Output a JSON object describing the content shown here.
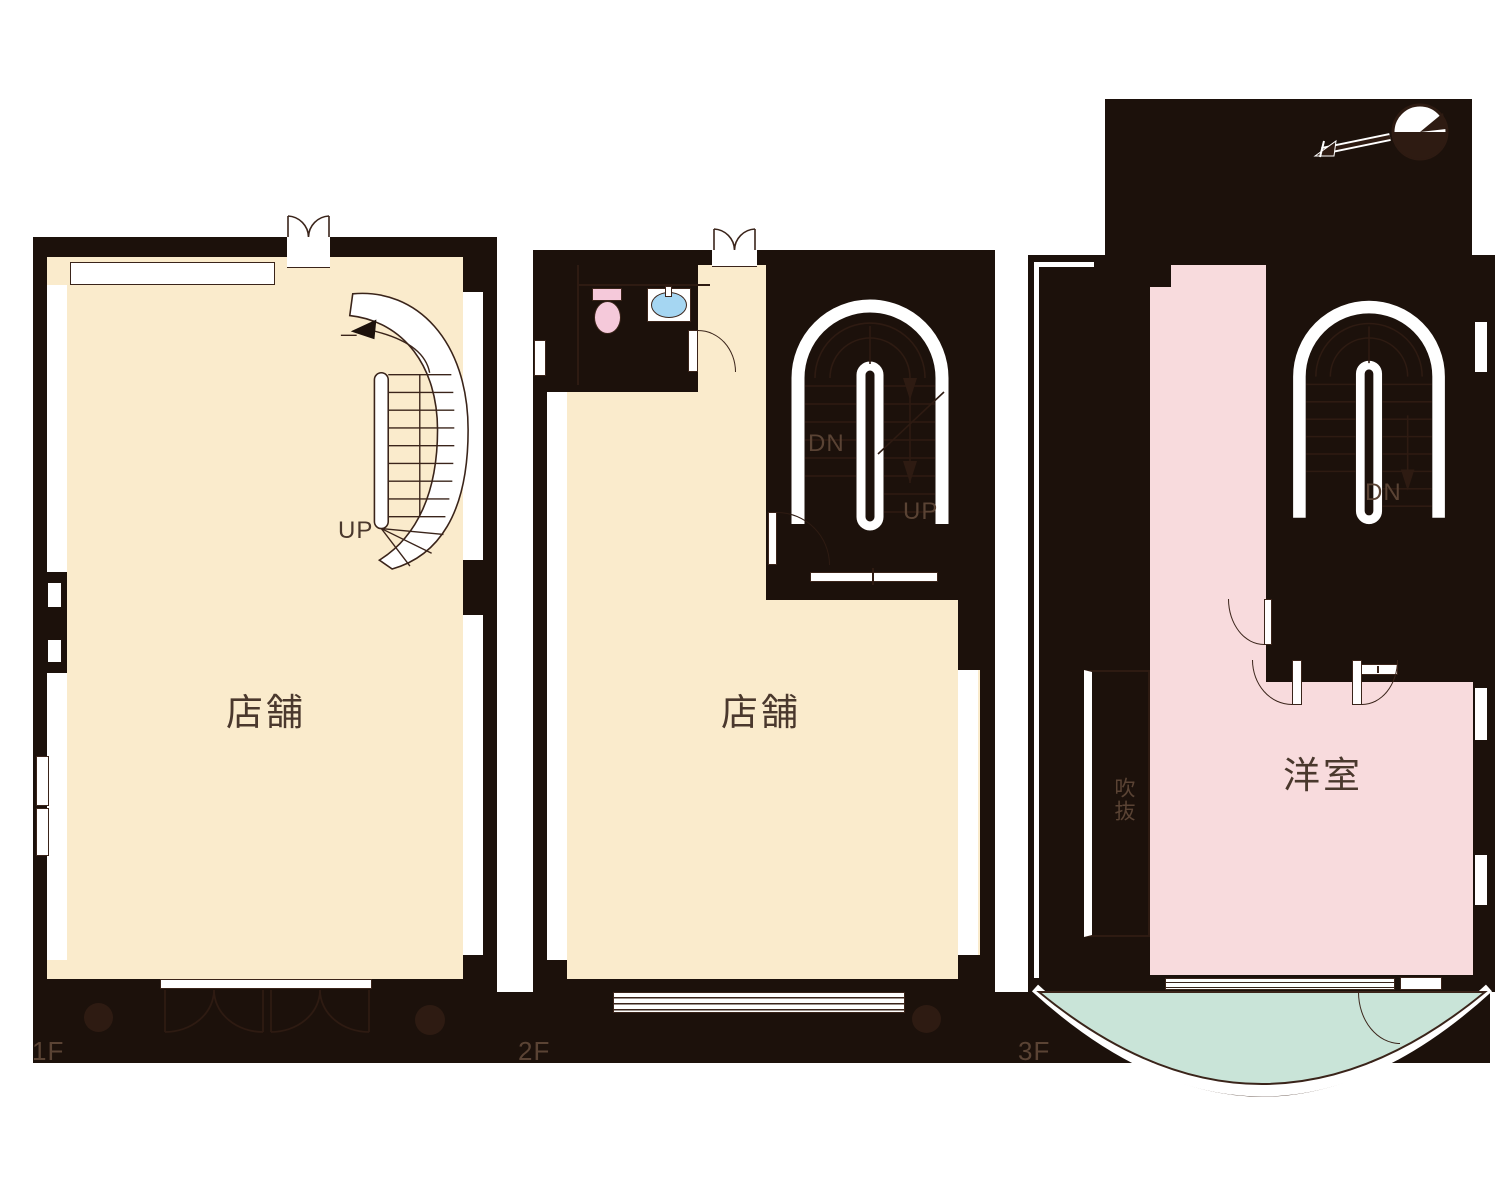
{
  "colors": {
    "paper": "#ffffff",
    "ink": "#1c110b",
    "ink_soft": "#2e1b12",
    "line": "#3a241a",
    "label": "#4a382d",
    "label_on_ink": "#5a4334",
    "cream": "#faebcc",
    "pink": "#f8dbdd",
    "mint": "#c9e4d8",
    "toilet_pink": "#f5c9da",
    "sink_blue": "#a5d6f2"
  },
  "floors": [
    {
      "id": "1f",
      "floor_label": "1F",
      "room_label": "店舗",
      "stair_up_label": "UP"
    },
    {
      "id": "2f",
      "floor_label": "2F",
      "room_label": "店舗",
      "stair_dn_label": "DN",
      "stair_up_label": "UP"
    },
    {
      "id": "3f",
      "floor_label": "3F",
      "room_label": "洋室",
      "void_label": "吹抜",
      "stair_dn_label": "DN"
    }
  ],
  "icons": [
    "compass-north-icon",
    "spiral-stair-icon",
    "u-stair-icon",
    "toilet-icon",
    "sink-icon",
    "pillar-icon",
    "balcony-icon"
  ]
}
